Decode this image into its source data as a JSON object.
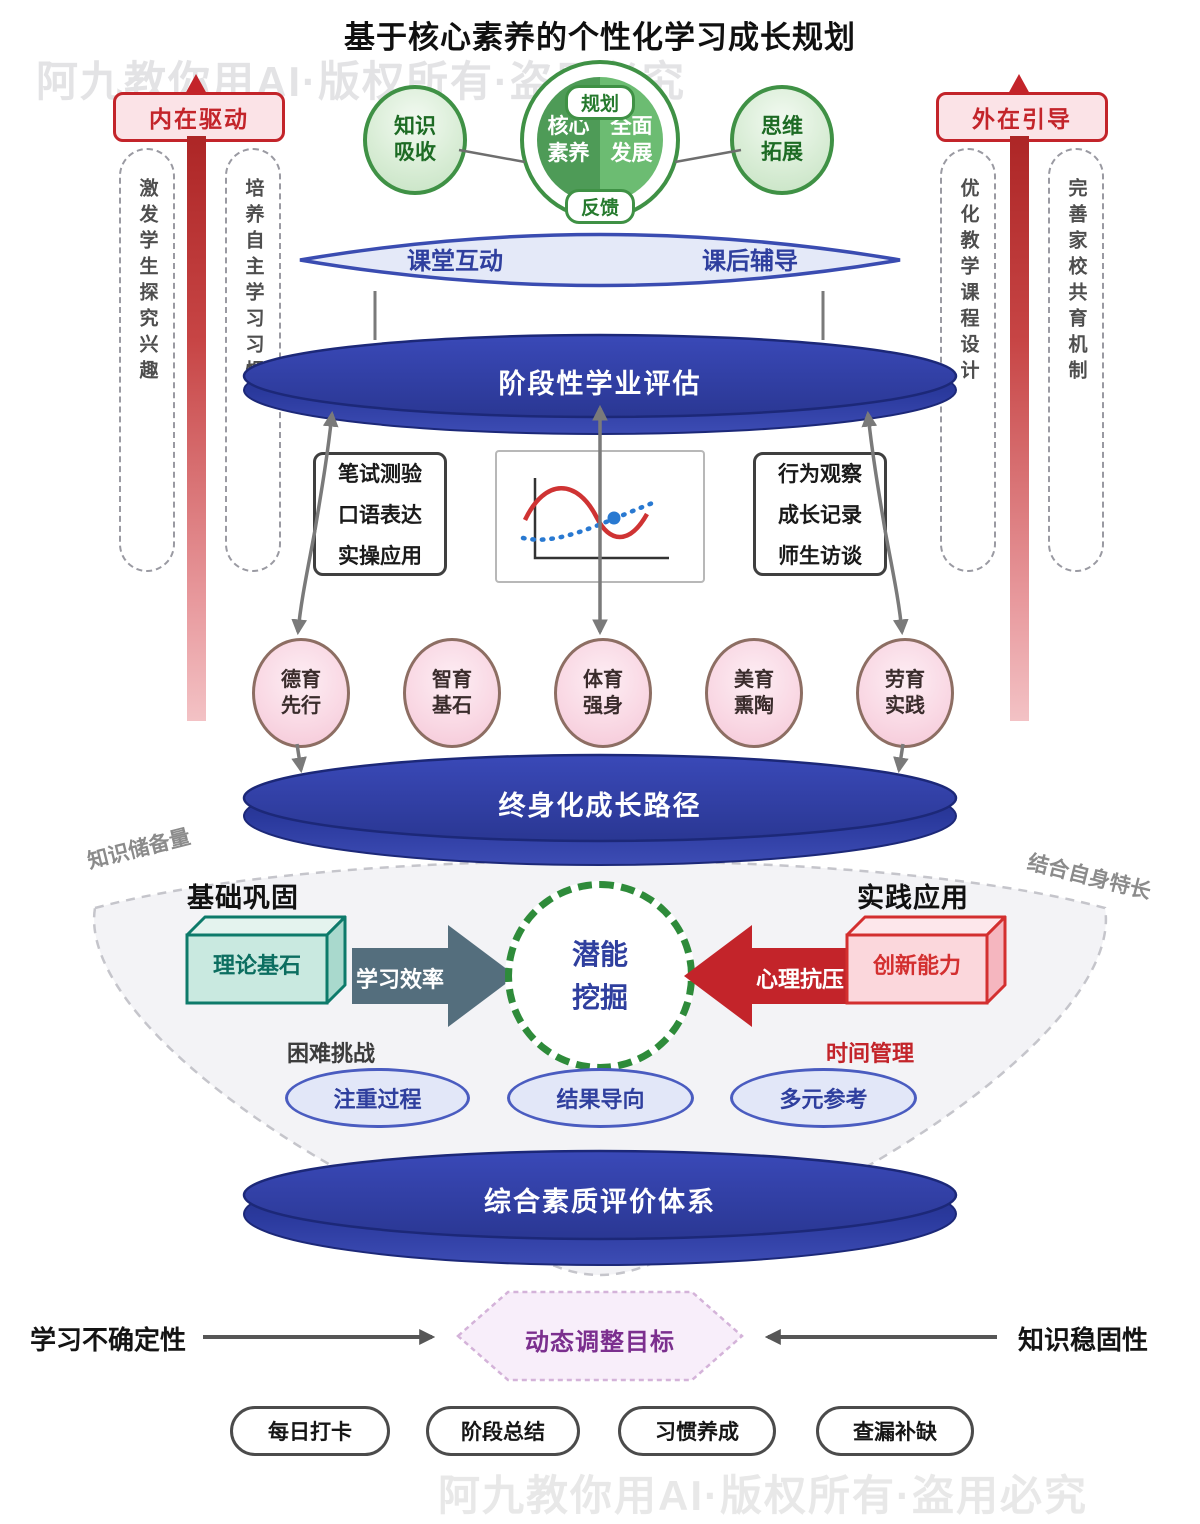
{
  "title": "基于核心素养的个性化学习成长规划",
  "watermarks": {
    "top": "阿九教你用AI·版权所有·盗用必究",
    "bottom": "阿九教你用AI·版权所有·盗用必究"
  },
  "core": {
    "left_circle": {
      "line1": "知识",
      "line2": "吸收"
    },
    "right_circle": {
      "line1": "思维",
      "line2": "拓展"
    },
    "center_circle": {
      "left_top": "核心",
      "left_bottom": "素养",
      "right_top": "全面",
      "right_bottom": "发展",
      "tag_top": "规划",
      "tag_bottom": "反馈"
    }
  },
  "drivers": {
    "left": {
      "banner": "内在驱动",
      "capsules": [
        "激发学生探究兴趣",
        "培养自主学习习惯"
      ]
    },
    "right": {
      "banner": "外在引导",
      "capsules": [
        "优化教学课程设计",
        "完善家校共育机制"
      ]
    }
  },
  "lens": {
    "left": "课堂互动",
    "right": "课后辅导"
  },
  "discs": {
    "assessment": "阶段性学业评估",
    "lifelong_path": "终身化成长路径",
    "quality_system": "综合素质评价体系"
  },
  "assessment_methods": {
    "exam": [
      "笔试测验",
      "口语表达",
      "实操应用"
    ],
    "observe": [
      "行为观察",
      "成长记录",
      "师生访谈"
    ]
  },
  "five_educations": [
    {
      "line1": "德育",
      "line2": "先行"
    },
    {
      "line1": "智育",
      "line2": "基石"
    },
    {
      "line1": "体育",
      "line2": "强身"
    },
    {
      "line1": "美育",
      "line2": "熏陶"
    },
    {
      "line1": "劳育",
      "line2": "实践"
    }
  ],
  "potential": {
    "rotated_left": "知识储备量",
    "rotated_right": "结合自身特长",
    "heading_left": "基础巩固",
    "heading_right": "实践应用",
    "box_left": "理论基石",
    "box_right": "创新能力",
    "arrow_right_label": "学习效率",
    "arrow_left_label": "心理抗压",
    "center": {
      "line1": "潜能",
      "line2": "挖掘"
    },
    "label_challenge": "困难挑战",
    "label_time": "时间管理",
    "pills": [
      "注重过程",
      "结果导向",
      "多元参考"
    ]
  },
  "adjust": {
    "hexagon": "动态调整目标",
    "left_label": "学习不确定性",
    "right_label": "知识稳固性"
  },
  "actions": [
    "每日打卡",
    "阶段总结",
    "习惯养成",
    "查漏补缺"
  ],
  "palette": {
    "disc_blue": "#2c3a9e",
    "green": "#3f9145",
    "green_dark_half": "#4e9b57",
    "green_light_half": "#6cbc72",
    "red": "#c3242a",
    "pink_circle": "#f9d7e3",
    "teal": "#0d7a6a",
    "slate_arrow": "#546e7d",
    "lavender": "#e2e7f8",
    "purple": "#7b2f8e"
  }
}
